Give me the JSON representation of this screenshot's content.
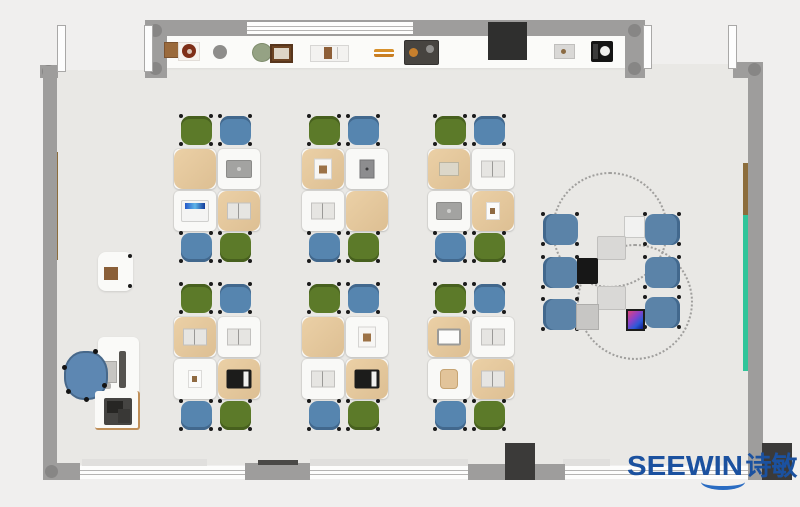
{
  "logo": {
    "brand": "SEEWIN",
    "cn": "诗敏",
    "color": "#1b519f"
  },
  "palette": {
    "floor": "#e9e8e5",
    "outside": "#f0efee",
    "wall": "#9e9d9c",
    "wall_corner_dot": "#878685",
    "column_dark": "#3b3a39",
    "counter_white": "#fbfbf9",
    "chair_green": "#5c7a29",
    "chair_green_dark": "#47601e",
    "chair_blue": "#5685af",
    "chair_blue_dark": "#42688d",
    "collab_chair_blue": "#5b83a8",
    "desk_white": "#f9f9f7",
    "bag_tan": "#e4c79c",
    "board_brown": "#8c6d3c",
    "board_green": "#30c59a",
    "office_chair_blue": "#5d87b2"
  },
  "cluster_layout": {
    "chairs_top": [
      "green",
      "blue"
    ],
    "chairs_bottom": [
      "blue",
      "green"
    ],
    "desk_offsets": [
      [
        1,
        33
      ],
      [
        45,
        33
      ],
      [
        1,
        75
      ],
      [
        45,
        75
      ]
    ],
    "desk_size": [
      42,
      40
    ],
    "chair_size": [
      31,
      29
    ],
    "chair_x_offsets": [
      8,
      47
    ],
    "chair_bottom_y": 117
  },
  "clusters": [
    {
      "id": "row1-col1",
      "x": 173,
      "y": 116,
      "desks": [
        {
          "cover": "tan",
          "item": "none"
        },
        {
          "cover": "white",
          "item": "laptop-dark"
        },
        {
          "cover": "white",
          "item": "laptop-open"
        },
        {
          "cover": "tan",
          "item": "book-open"
        }
      ]
    },
    {
      "id": "row1-col2",
      "x": 301,
      "y": 116,
      "desks": [
        {
          "cover": "tan",
          "item": "book-white"
        },
        {
          "cover": "white",
          "item": "tablet-dark"
        },
        {
          "cover": "white",
          "item": "book-open"
        },
        {
          "cover": "tan",
          "item": "none"
        }
      ]
    },
    {
      "id": "row1-col3",
      "x": 427,
      "y": 116,
      "desks": [
        {
          "cover": "tan",
          "item": "notebook"
        },
        {
          "cover": "white",
          "item": "book-open"
        },
        {
          "cover": "white",
          "item": "laptop-dark"
        },
        {
          "cover": "tan",
          "item": "paper"
        }
      ]
    },
    {
      "id": "row2-col1",
      "x": 173,
      "y": 284,
      "desks": [
        {
          "cover": "tan",
          "item": "book-open"
        },
        {
          "cover": "white",
          "item": "book-open"
        },
        {
          "cover": "white",
          "item": "paper"
        },
        {
          "cover": "tan",
          "item": "laptop-black"
        }
      ]
    },
    {
      "id": "row2-col2",
      "x": 301,
      "y": 284,
      "desks": [
        {
          "cover": "tan",
          "item": "none"
        },
        {
          "cover": "white",
          "item": "book-white"
        },
        {
          "cover": "white",
          "item": "book-open"
        },
        {
          "cover": "tan",
          "item": "laptop-black"
        }
      ]
    },
    {
      "id": "row2-col3",
      "x": 427,
      "y": 284,
      "desks": [
        {
          "cover": "tan",
          "item": "monitor"
        },
        {
          "cover": "white",
          "item": "book-open"
        },
        {
          "cover": "white",
          "item": "bag"
        },
        {
          "cover": "tan",
          "item": "book-open"
        }
      ]
    }
  ],
  "collab_area": {
    "circles": [
      {
        "x": 552,
        "y": 172,
        "d": 112
      },
      {
        "x": 577,
        "y": 244,
        "d": 112
      }
    ],
    "chair_size": [
      35,
      31
    ],
    "chairs": [
      {
        "x": 543,
        "y": 214,
        "side": "left"
      },
      {
        "x": 543,
        "y": 257,
        "side": "left"
      },
      {
        "x": 543,
        "y": 299,
        "side": "left"
      },
      {
        "x": 645,
        "y": 214,
        "side": "right"
      },
      {
        "x": 645,
        "y": 257,
        "side": "right"
      },
      {
        "x": 645,
        "y": 297,
        "side": "right"
      }
    ],
    "devices": [
      {
        "kind": "tablet-blue",
        "x": 624,
        "y": 216
      },
      {
        "kind": "pad-gray",
        "x": 597,
        "y": 236
      },
      {
        "kind": "laptop-black",
        "x": 577,
        "y": 258
      },
      {
        "kind": "pad-gray",
        "x": 597,
        "y": 286
      },
      {
        "kind": "laptop-gray",
        "x": 576,
        "y": 304
      },
      {
        "kind": "phone-color",
        "x": 626,
        "y": 309
      }
    ]
  },
  "shelf_items": [
    {
      "kind": "box-brown",
      "x": 164,
      "y": 42
    },
    {
      "kind": "torus-red",
      "x": 178,
      "y": 42
    },
    {
      "kind": "ball-gray",
      "x": 213,
      "y": 45
    },
    {
      "kind": "plant-green",
      "x": 252,
      "y": 43
    },
    {
      "kind": "frame-brown",
      "x": 270,
      "y": 44
    },
    {
      "kind": "books-white",
      "x": 310,
      "y": 45
    },
    {
      "kind": "sticks-orange",
      "x": 374,
      "y": 49
    },
    {
      "kind": "tray-dark",
      "x": 404,
      "y": 40
    },
    {
      "kind": "tray-gray",
      "x": 554,
      "y": 44
    },
    {
      "kind": "device-bw",
      "x": 591,
      "y": 41
    }
  ],
  "teacher_station": {
    "cabinet": {
      "x": 98,
      "y": 252,
      "w": 35,
      "h": 39
    },
    "desk": {
      "x": 98,
      "y": 337,
      "w": 41,
      "h": 61
    },
    "monitor": {
      "x": 119,
      "y": 351,
      "w": 7,
      "h": 37
    },
    "keyboard": {
      "x": 103,
      "y": 361,
      "w": 12,
      "h": 20
    },
    "mouse": {
      "x": 104,
      "y": 383,
      "w": 7,
      "h": 6
    },
    "office_chair": {
      "x": 64,
      "y": 351,
      "w": 40,
      "h": 45
    },
    "printer_desk": {
      "x": 95,
      "y": 391,
      "w": 43,
      "h": 37
    },
    "printer": {
      "x": 104,
      "y": 398,
      "w": 28,
      "h": 27
    }
  }
}
